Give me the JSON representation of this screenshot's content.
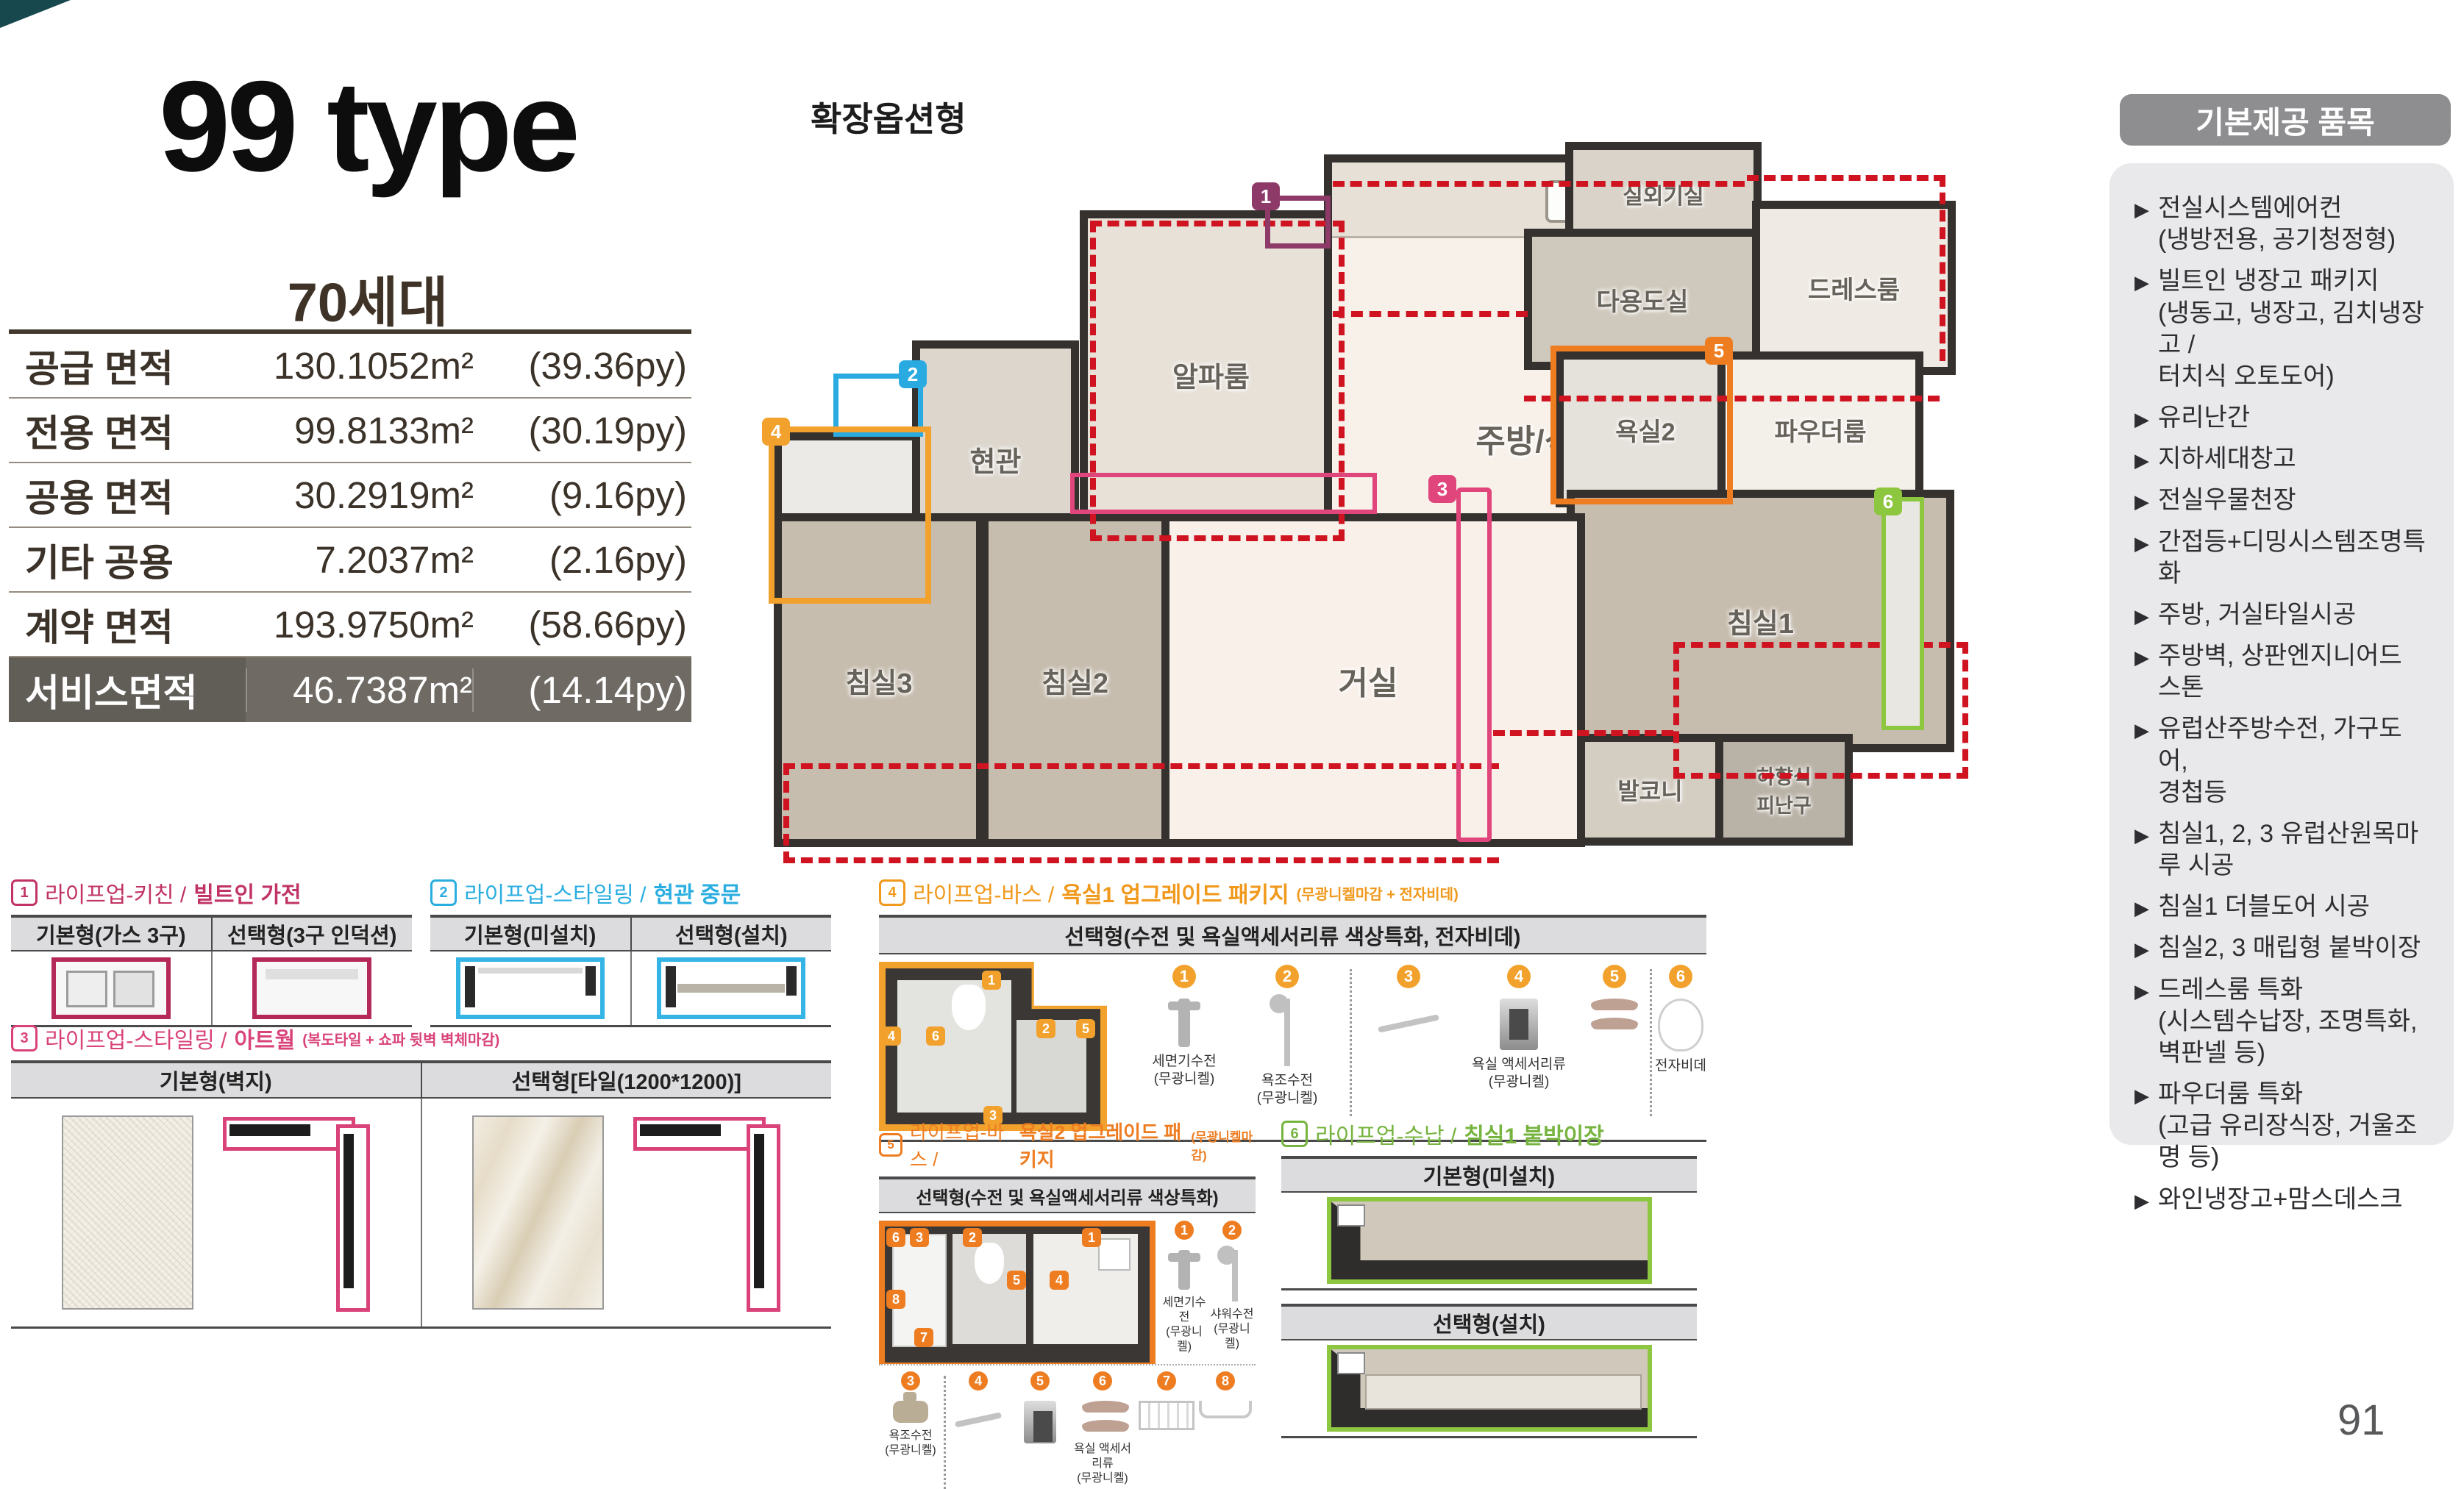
{
  "page": {
    "number": "91"
  },
  "unit": {
    "title": "99 type",
    "households": "70세대",
    "area_rows": [
      {
        "label": "공급 면적",
        "sqm": "130.1052m²",
        "py": "(39.36py)"
      },
      {
        "label": "전용 면적",
        "sqm": "99.8133m²",
        "py": "(30.19py)"
      },
      {
        "label": "공용 면적",
        "sqm": "30.2919m²",
        "py": "(9.16py)"
      },
      {
        "label": "기타 공용",
        "sqm": "7.2037m²",
        "py": "(2.16py)"
      },
      {
        "label": "계약 면적",
        "sqm": "193.9750m²",
        "py": "(58.66py)"
      },
      {
        "label": "서비스면적",
        "sqm": "46.7387m²",
        "py": "(14.14py)"
      }
    ]
  },
  "floorplan": {
    "title": "확장옵션형",
    "rooms": {
      "alpha": "알파룸",
      "entry": "현관",
      "pantry": "팬트리",
      "kitchen": "주방/식당",
      "utility": "다용도실",
      "outdoor_unit": "실외기실",
      "dressroom": "드레스룸",
      "bath2": "욕실2",
      "powder": "파우더룸",
      "bed1": "침실1",
      "bath1": "욕실1",
      "bed3": "침실3",
      "bed2": "침실2",
      "living": "거실",
      "balcony": "발코니",
      "escape": "하향식\n피난구"
    },
    "markers": {
      "m1": "1",
      "m2": "2",
      "m3": "3",
      "m4": "4",
      "m5": "5",
      "m6": "6"
    }
  },
  "provided": {
    "header": "기본제공 품목",
    "bullet": "▶",
    "items": [
      "전실시스템에어컨\n(냉방전용, 공기청정형)",
      "빌트인 냉장고 패키지\n(냉동고, 냉장고, 김치냉장고 /\n터치식 오토도어)",
      "유리난간",
      "지하세대창고",
      "전실우물천장",
      "간접등+디밍시스템조명특화",
      "주방, 거실타일시공",
      "주방벽, 상판엔지니어드 스톤",
      "유럽산주방수전, 가구도어,\n경첩등",
      "침실1, 2, 3 유럽산원목마루 시공",
      "침실1 더블도어 시공",
      "침실2, 3 매립형 붙박이장",
      "드레스룸 특화\n(시스템수납장, 조명특화,\n벽판넬 등)",
      "파우더룸 특화\n(고급 유리장식장, 거울조명 등)",
      "와인냉장고+맘스데스크"
    ]
  },
  "options": {
    "kitchen": {
      "num": "1",
      "category": "라이프업-키친 /",
      "name": "빌트인 가전",
      "col1": "기본형(가스 3구)",
      "col2": "선택형(3구 인덕션)"
    },
    "entry_door": {
      "num": "2",
      "category": "라이프업-스타일링 /",
      "name": "현관 중문",
      "col1": "기본형(미설치)",
      "col2": "선택형(설치)"
    },
    "artwall": {
      "num": "3",
      "category": "라이프업-스타일링 /",
      "name": "아트월",
      "suffix": "(복도타일 + 쇼파 뒷벽 벽체마감)",
      "col1": "기본형(벽지)",
      "col2": "선택형[타일(1200*1200)]"
    },
    "bath1": {
      "num": "4",
      "category": "라이프업-바스 /",
      "name": "욕실1 업그레이드 패키지",
      "suffix": "(무광니켈마감 + 전자비데)",
      "header": "선택형(수전 및 욕실액세서리류 색상특화, 전자비데)",
      "items": [
        {
          "num": "1",
          "label": "세면기수전\n(무광니켈)"
        },
        {
          "num": "2",
          "label": "욕조수전\n(무광니켈)"
        },
        {
          "num": "3",
          "label": ""
        },
        {
          "num": "4",
          "label": "욕실 액세서리류\n(무광니켈)"
        },
        {
          "num": "5",
          "label": ""
        },
        {
          "num": "6",
          "label": "전자비데"
        }
      ]
    },
    "bath2": {
      "num": "5",
      "category": "라이프업-바스 /",
      "name": "욕실2 업그레이드 패키지",
      "suffix": "(무광니켈마감)",
      "header": "선택형(수전 및 욕실액세서리류 색상특화)",
      "items_right": [
        {
          "num": "1",
          "label": "세면기수전\n(무광니켈)"
        },
        {
          "num": "2",
          "label": "샤워수전\n(무광니켈)"
        }
      ],
      "items_bottom": [
        {
          "num": "3",
          "label": "욕조수전\n(무광니켈)"
        },
        {
          "num": "4",
          "label": ""
        },
        {
          "num": "5",
          "label": ""
        },
        {
          "num": "6",
          "label": "욕실 액세서리류\n(무광니켈)"
        },
        {
          "num": "7",
          "label": ""
        },
        {
          "num": "8",
          "label": ""
        }
      ]
    },
    "storage": {
      "num": "6",
      "category": "라이프업-수납 /",
      "name": "침실1 붙박이장",
      "col1": "기본형(미설치)",
      "col2": "선택형(설치)"
    }
  }
}
